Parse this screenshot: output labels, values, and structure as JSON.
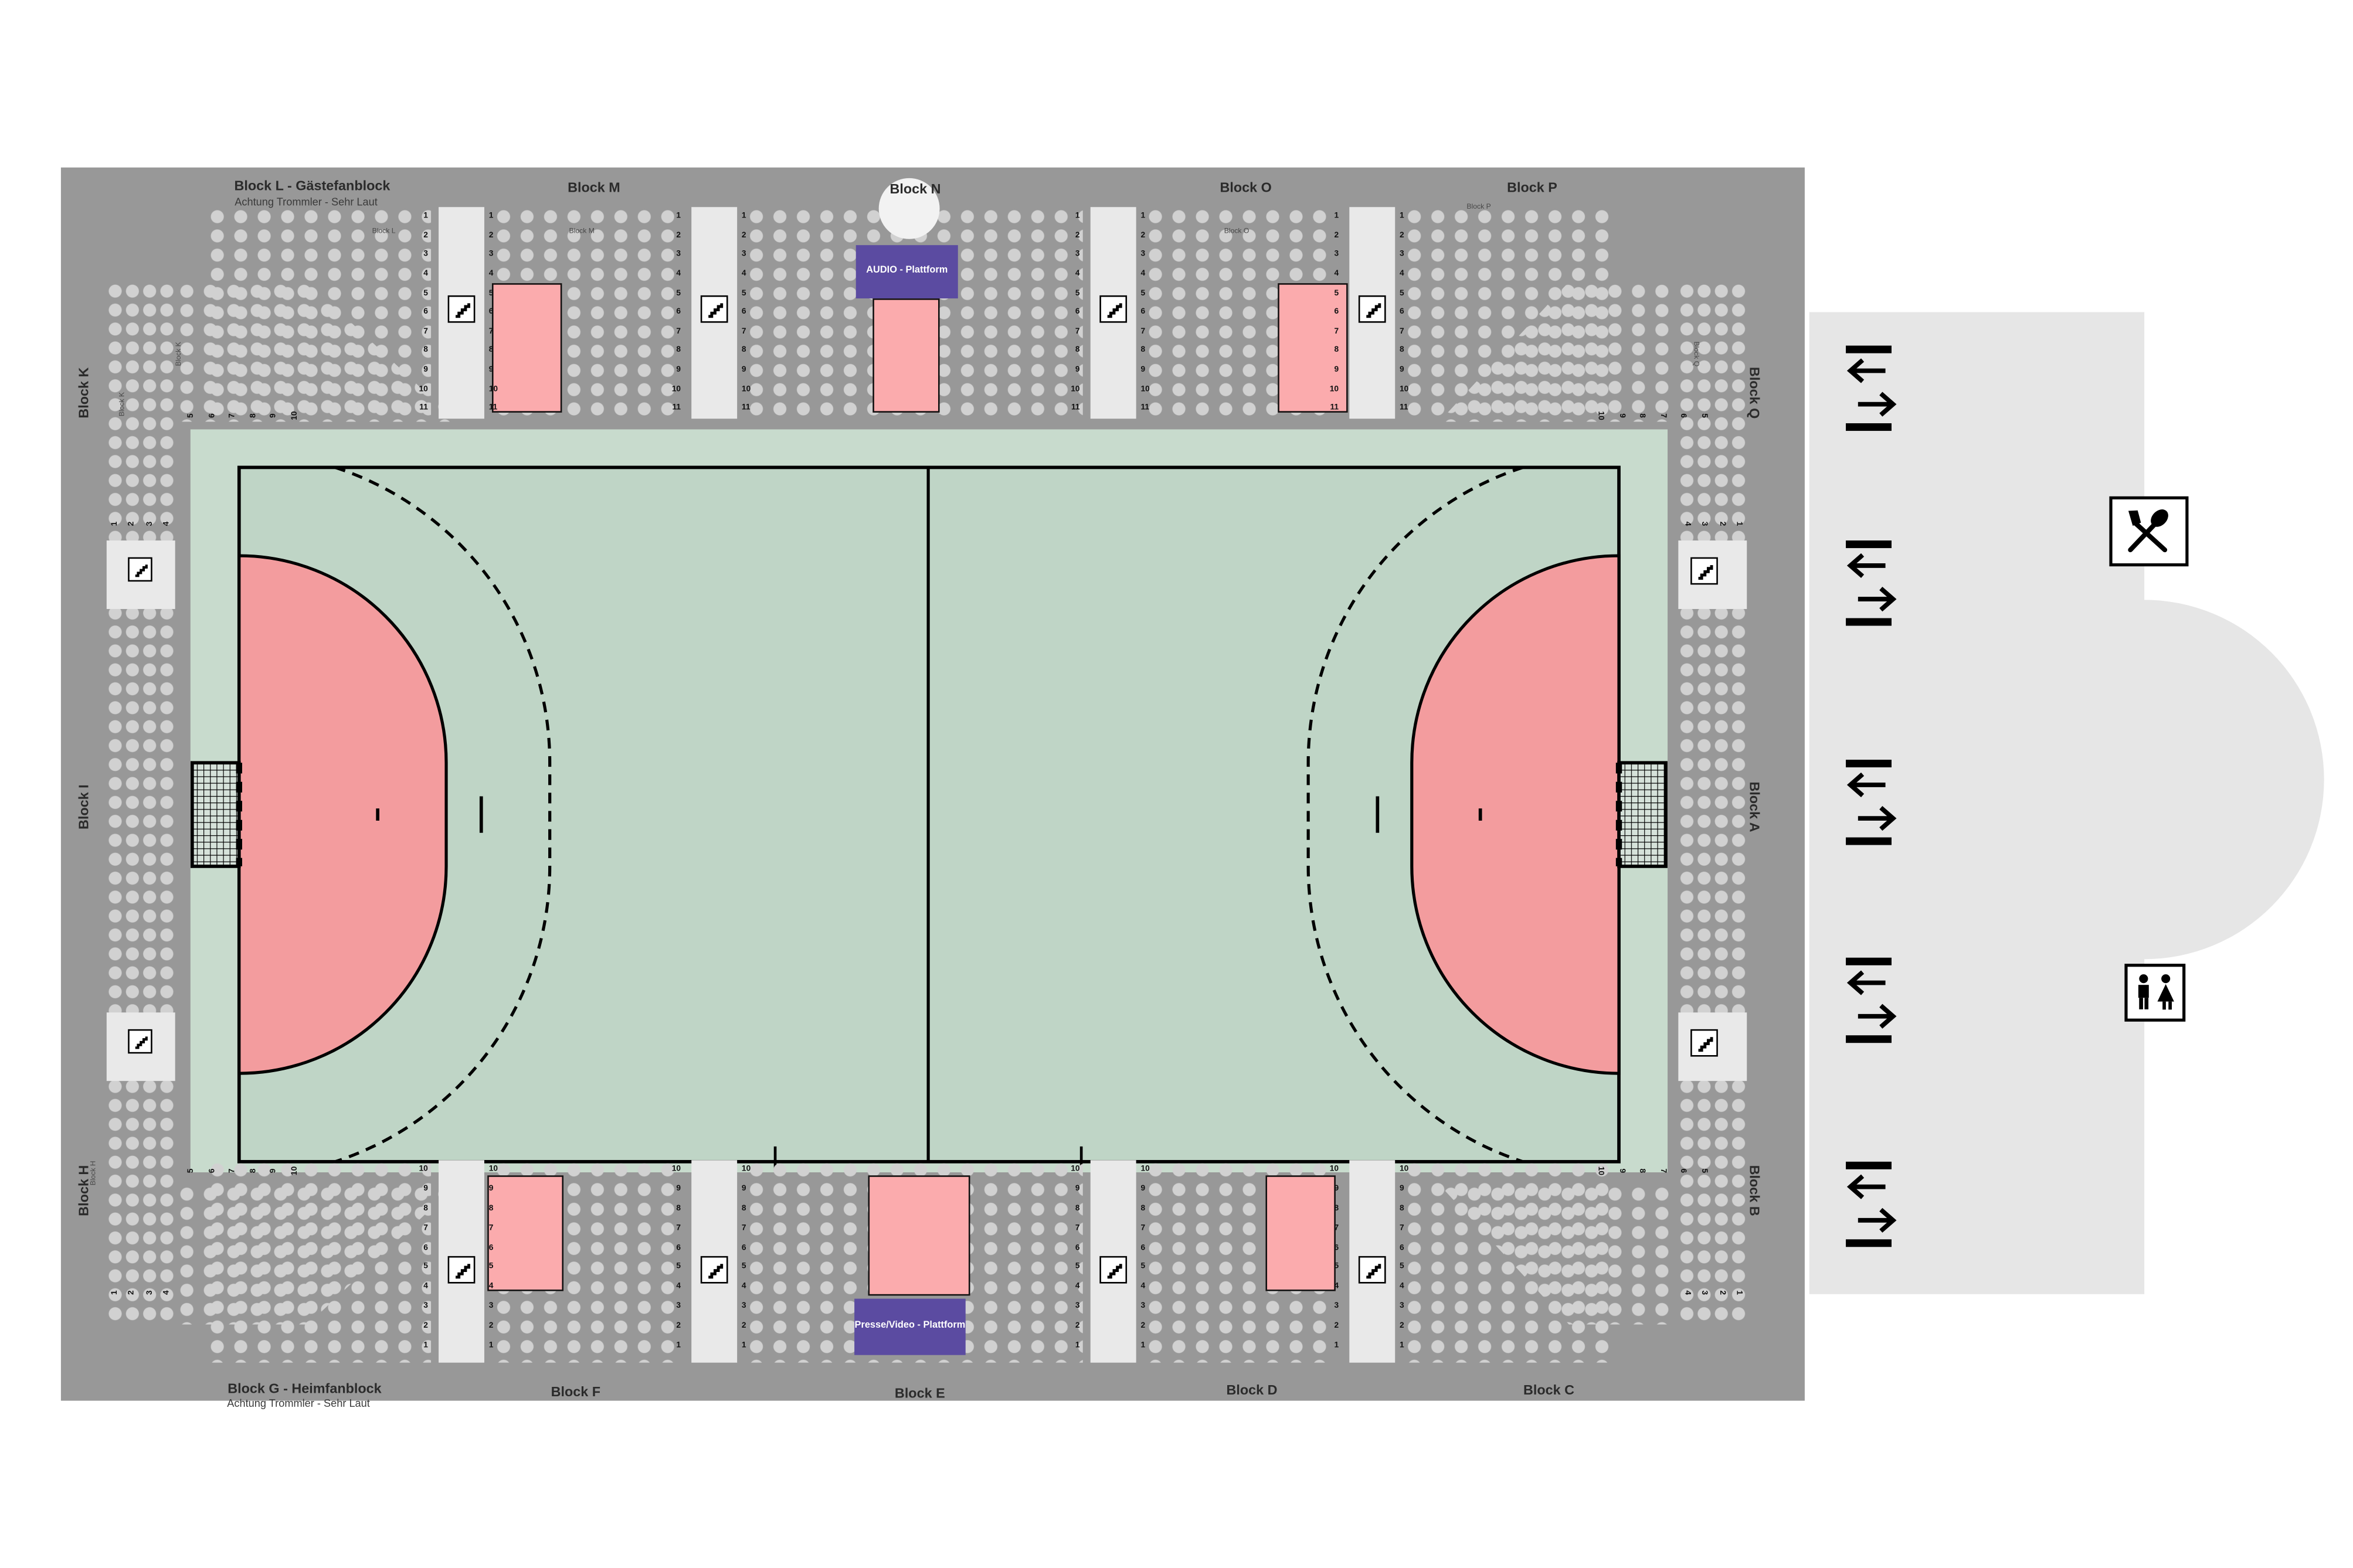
{
  "blocks": {
    "L": {
      "label": "Block L - Gästefanblock",
      "note": "Achtung Trommler - Sehr Laut",
      "short": "Block L"
    },
    "M": {
      "label": "Block M",
      "short": "Block M"
    },
    "N": {
      "label": "Block N",
      "short": "Block N"
    },
    "O": {
      "label": "Block O",
      "short": "Block O"
    },
    "P": {
      "label": "Block P",
      "short": "Block P"
    },
    "Q": {
      "label": "Block Q",
      "short": "Block Q"
    },
    "A": {
      "label": "Block A",
      "short": "Block A"
    },
    "B": {
      "label": "Block B",
      "short": "Block B"
    },
    "C": {
      "label": "Block C",
      "short": "Block C"
    },
    "D": {
      "label": "Block D",
      "short": "Block D"
    },
    "E": {
      "label": "Block E",
      "short": "Block E"
    },
    "F": {
      "label": "Block F",
      "short": "Block F"
    },
    "G": {
      "label": "Block G - Heimfanblock",
      "note": "Achtung Trommler - Sehr Laut",
      "short": "Block G"
    },
    "H": {
      "label": "Block H",
      "short": "Block H"
    },
    "I": {
      "label": "Block I",
      "short": "Block I"
    },
    "K": {
      "label": "Block K",
      "short": "Block K"
    }
  },
  "platforms": {
    "audio": {
      "label": "AUDIO - Plattform"
    },
    "press": {
      "label": "Presse/Video - Plattform"
    }
  },
  "numbers": {
    "rows_top": [
      "1",
      "2",
      "3",
      "4",
      "5",
      "6",
      "7",
      "8",
      "9",
      "10",
      "11"
    ],
    "rows_bottom": [
      "10",
      "9",
      "8",
      "7",
      "6",
      "5",
      "4",
      "3",
      "2",
      "1"
    ],
    "side_cols": [
      "1",
      "2",
      "3",
      "4"
    ],
    "corner_cols": [
      "5",
      "6",
      "7",
      "8",
      "9",
      "10"
    ]
  },
  "colors": {
    "stand_gray": "#989898",
    "seat_dot": "#d1d1d1",
    "aisle_white": "#e9e9e9",
    "promenade_gray": "#e6e6e6",
    "field_green": "#c8dbcd",
    "court_green": "#bfd5c6",
    "goal_area_pink": "#f39c9e",
    "standing_pink": "#fbabad",
    "platform_purple": "#5b4ba1"
  },
  "icons": {
    "stairs": "stairs-icon",
    "gate": "entrance-exit-icon",
    "restaurant": "restaurant-icon",
    "wc": "wc-icon"
  }
}
